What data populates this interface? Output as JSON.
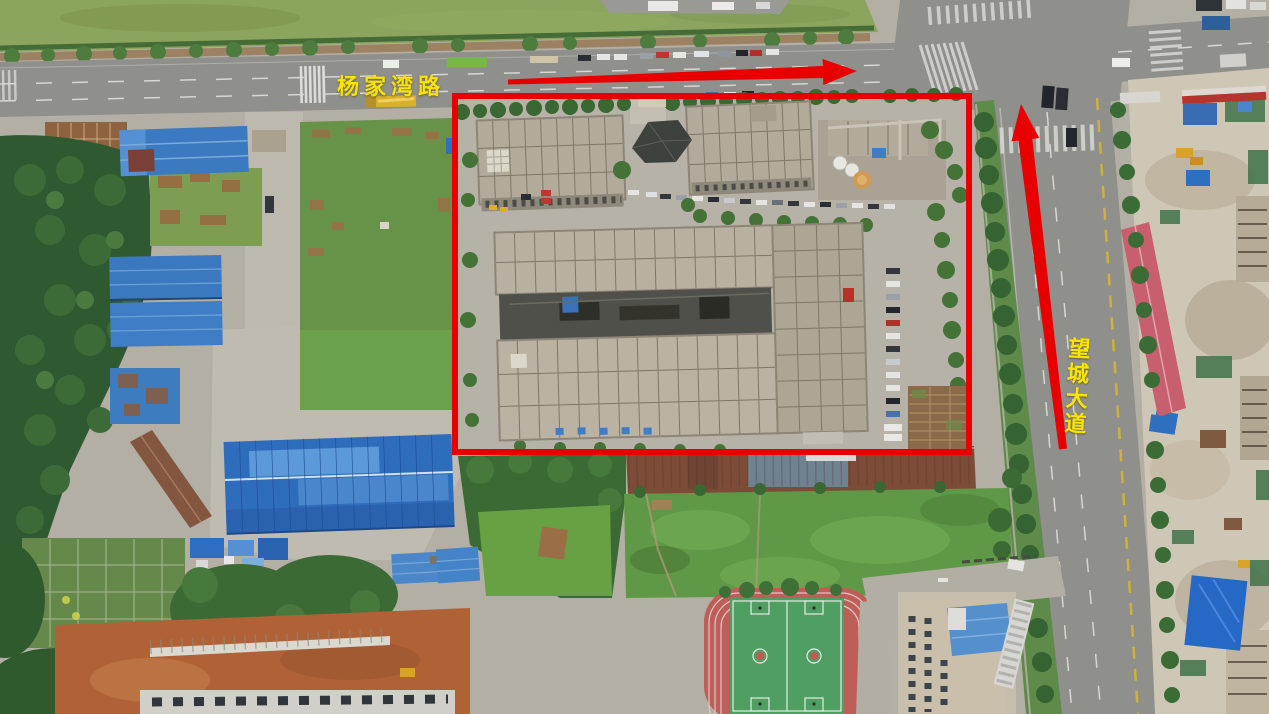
{
  "annotations": {
    "top_road_label": "杨家湾路",
    "right_road_label": "望城大道",
    "label_color": "#f8e400",
    "highlight_color": "#e80000",
    "site_boundary": {
      "x": 452,
      "y": 93,
      "width": 520,
      "height": 362
    },
    "arrows": [
      {
        "icon": "right-arrow-icon",
        "direction": "east along top road"
      },
      {
        "icon": "up-arrow-icon",
        "direction": "north along right road"
      }
    ]
  }
}
